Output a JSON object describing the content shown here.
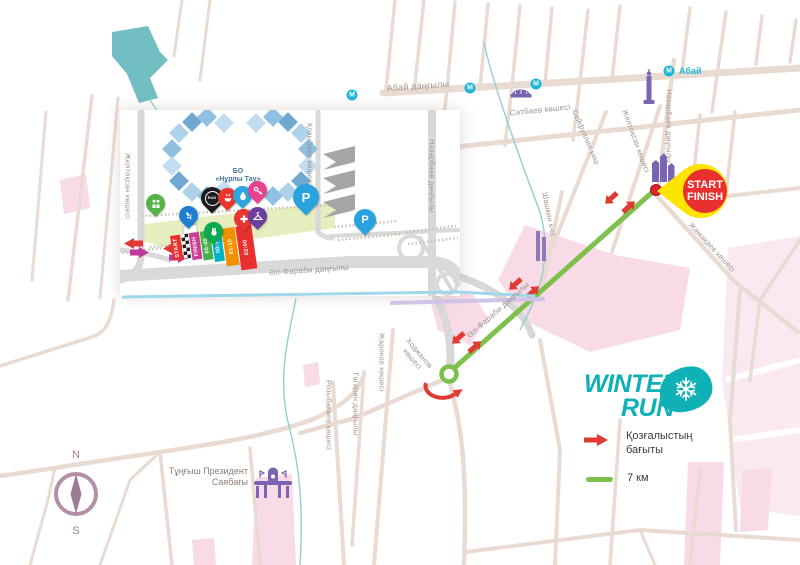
{
  "streets": {
    "abay": "Абай даңғылы",
    "satbaev": "Сәтбаев көшесі",
    "seifullin": "Сейфуллин көш",
    "zheltoksan": "Желтоқсан көшесі",
    "nazarbayev": "Назарбаев даңғылы",
    "zhamakayev": "Жамақаев көшесі",
    "shashkin": "Шашкин к-сі",
    "alfarabi": "Әл-Фараби даңғылы",
    "khodzhanov_1": "Ходжанов",
    "khodzhanov_2": "көшесі",
    "zharokov": "Жароков көшесі",
    "rozybakiev": "Розыбакиев көшесі",
    "gagarin": "Гагарин даңғылы",
    "kozybaev": "Қозыбаев көшесі"
  },
  "places": {
    "nurly_line1": "БО",
    "nurly_line2": "«Нұрлы Тау»",
    "park_line1": "Тұңғыш Президент",
    "park_line2": "Саябағы",
    "metro_letter": "М",
    "metro_station": "Абай"
  },
  "badge": {
    "line1": "START",
    "line2": "FINISH"
  },
  "corrals": [
    {
      "label": "START",
      "color": "#e8312e"
    },
    {
      "label": "",
      "color": ""
    },
    {
      "label": "FINISH",
      "color": "#cb3d96"
    },
    {
      "label": "00:40",
      "color": "#43b04a"
    },
    {
      "label": "00:55",
      "color": "#00b2c8"
    },
    {
      "label": "01:10",
      "color": "#f39200"
    },
    {
      "label": "02:00",
      "color": "#e8312e"
    }
  ],
  "legend": {
    "direction_line1": "Қозғалыстың",
    "direction_line2": "бағыты",
    "distance": "7 км"
  },
  "logo": {
    "line1": "WINTER",
    "line2": "RUN"
  },
  "compass": {
    "north": "N",
    "south": "S"
  },
  "pins": {
    "parking_label": "P",
    "logo_pin_label": "RUN"
  },
  "colors": {
    "route_green": "#7dc04b",
    "arrow_red": "#e03a34",
    "arrow_magenta": "#c0399f",
    "badge_yellow": "#ffe400",
    "badge_red": "#e8312e",
    "logo_teal": "#0fb0b6",
    "metro_teal": "#1fb6d5",
    "landmark_purple": "#7a65b5",
    "road_beige": "#eadbd2",
    "road_grey": "#d8d8d8",
    "pink_zone": "#f8dbe7",
    "water_teal": "#72bec2",
    "promenade_green": "#e6edbf",
    "compass_mauve": "#a8879e"
  }
}
